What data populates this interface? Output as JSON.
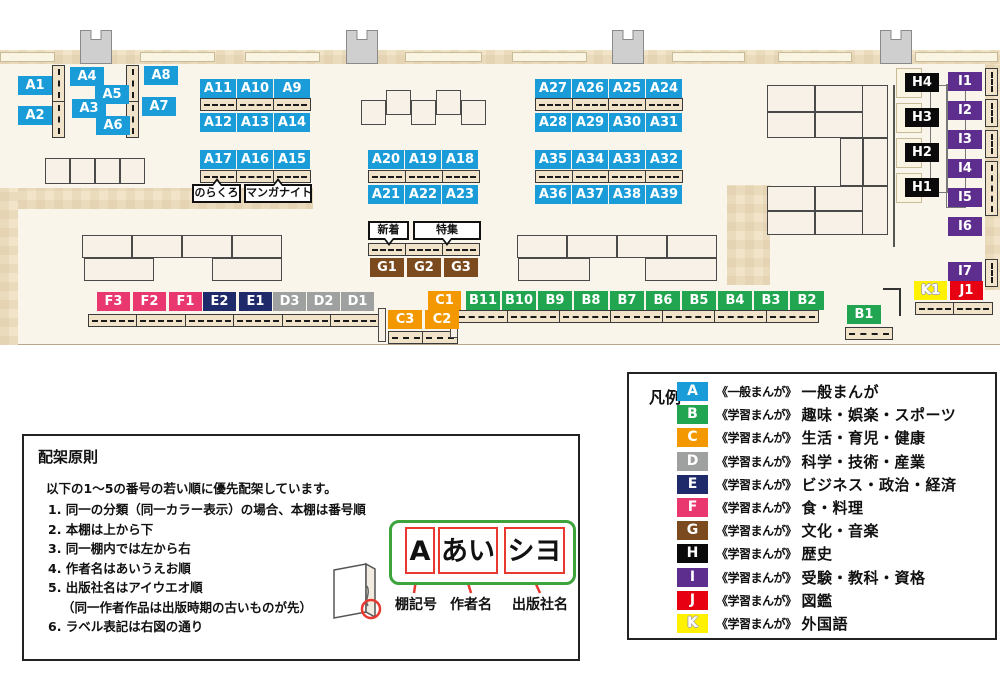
{
  "colors": {
    "A": "#1A9CD8",
    "B": "#22A550",
    "C": "#F39800",
    "D": "#9FA0A0",
    "E": "#1E2A69",
    "F": "#E8386F",
    "G": "#7C4A1F",
    "H": "#0A0A0A",
    "I": "#5E2E8E",
    "J": "#E60012",
    "K": "#FFF100"
  },
  "map": {
    "clusters": [
      {
        "cat": "A",
        "labels": [
          "A1",
          "A4",
          "A8",
          "A5",
          "A2",
          "A3",
          "A7",
          "A6"
        ]
      },
      {
        "cat": "A",
        "labels": [
          "A11",
          "A10",
          "A9"
        ]
      },
      {
        "cat": "A",
        "labels": [
          "A12",
          "A13",
          "A14"
        ]
      },
      {
        "cat": "A",
        "labels": [
          "A17",
          "A16",
          "A15"
        ]
      },
      {
        "cat": "A",
        "labels": [
          "A20",
          "A19",
          "A18"
        ]
      },
      {
        "cat": "A",
        "labels": [
          "A21",
          "A22",
          "A23"
        ]
      },
      {
        "cat": "A",
        "labels": [
          "A27",
          "A26",
          "A25",
          "A24"
        ]
      },
      {
        "cat": "A",
        "labels": [
          "A28",
          "A29",
          "A30",
          "A31"
        ]
      },
      {
        "cat": "A",
        "labels": [
          "A35",
          "A34",
          "A33",
          "A32"
        ]
      },
      {
        "cat": "A",
        "labels": [
          "A36",
          "A37",
          "A38",
          "A39"
        ]
      },
      {
        "cat": "G",
        "labels": [
          "G1",
          "G2",
          "G3"
        ]
      },
      {
        "cat": "F",
        "labels": [
          "F3",
          "F2",
          "F1"
        ]
      },
      {
        "cat": "E",
        "labels": [
          "E2",
          "E1"
        ]
      },
      {
        "cat": "D",
        "labels": [
          "D3",
          "D2",
          "D1"
        ]
      },
      {
        "cat": "C",
        "labels": [
          "C1"
        ]
      },
      {
        "cat": "B",
        "labels": [
          "B11",
          "B10",
          "B9",
          "B8",
          "B7",
          "B6",
          "B5",
          "B4",
          "B3",
          "B2"
        ]
      },
      {
        "cat": "C",
        "labels": [
          "C3",
          "C2"
        ]
      },
      {
        "cat": "B",
        "labels": [
          "B1"
        ]
      },
      {
        "cat": "H",
        "labels": [
          "H4",
          "H3",
          "H2",
          "H1"
        ]
      },
      {
        "cat": "I",
        "labels": [
          "I1",
          "I2",
          "I3",
          "I4",
          "I5",
          "I6"
        ]
      },
      {
        "cat": "I",
        "labels": [
          "I7"
        ]
      },
      {
        "cat": "K",
        "labels": [
          "K1"
        ]
      },
      {
        "cat": "J",
        "labels": [
          "J1"
        ]
      }
    ],
    "callouts": [
      {
        "text": "のらくろ"
      },
      {
        "text": "マンガナイト"
      },
      {
        "text": "新着"
      },
      {
        "text": "特集"
      }
    ]
  },
  "legend": {
    "title": "凡例",
    "items": [
      {
        "letter": "A",
        "scope": "《一般まんが》",
        "category": "一般まんが"
      },
      {
        "letter": "B",
        "scope": "《学習まんが》",
        "category": "趣味・娯楽・スポーツ"
      },
      {
        "letter": "C",
        "scope": "《学習まんが》",
        "category": "生活・育児・健康"
      },
      {
        "letter": "D",
        "scope": "《学習まんが》",
        "category": "科学・技術・産業"
      },
      {
        "letter": "E",
        "scope": "《学習まんが》",
        "category": "ビジネス・政治・経済"
      },
      {
        "letter": "F",
        "scope": "《学習まんが》",
        "category": "食・料理"
      },
      {
        "letter": "G",
        "scope": "《学習まんが》",
        "category": "文化・音楽"
      },
      {
        "letter": "H",
        "scope": "《学習まんが》",
        "category": "歴史"
      },
      {
        "letter": "I",
        "scope": "《学習まんが》",
        "category": "受験・教科・資格"
      },
      {
        "letter": "J",
        "scope": "《学習まんが》",
        "category": "図鑑"
      },
      {
        "letter": "K",
        "scope": "《学習まんが》",
        "category": "外国語"
      }
    ]
  },
  "principles": {
    "title": "配架原則",
    "intro": "以下の1～5の番号の若い順に優先配架しています。",
    "items": [
      {
        "text": "1. 同一の分類（同一カラー表示）の場合、本棚は番号順"
      },
      {
        "text": "2. 本棚は上から下"
      },
      {
        "text": "3. 同一棚内では左から右"
      },
      {
        "text": "4. 作者名はあいうえお順"
      },
      {
        "text": "5. 出版社名はアイウエオ順"
      },
      {
        "text": "（同一作者作品は出版時期の古いものが先）",
        "indent": true
      },
      {
        "text": "6. ラベル表記は右図の通り"
      }
    ],
    "diagram": {
      "label_parts": [
        "A",
        "あい",
        "シヨ"
      ],
      "captions": [
        "棚記号",
        "作者名",
        "出版社名"
      ]
    }
  }
}
